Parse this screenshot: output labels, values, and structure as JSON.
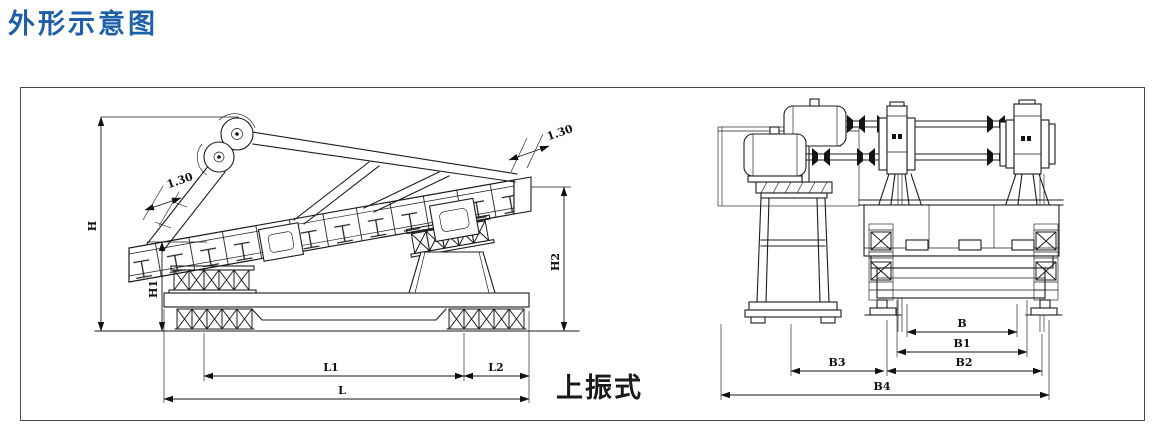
{
  "page": {
    "title": "外形示意图"
  },
  "colors": {
    "title_blue": "#1d5fa8",
    "line_dark": "#1c1c1c"
  },
  "figure": {
    "caption": "上振式",
    "side_view": {
      "labels": {
        "height": "H",
        "height1": "H1",
        "height2": "H2",
        "length": "L",
        "length1": "L1",
        "length2": "L2",
        "flange_left": "1.30",
        "flange_right": "1.30"
      }
    },
    "end_view": {
      "labels": {
        "b": "B",
        "b1": "B1",
        "b2": "B2",
        "b3": "B3",
        "b4": "B4"
      }
    }
  }
}
